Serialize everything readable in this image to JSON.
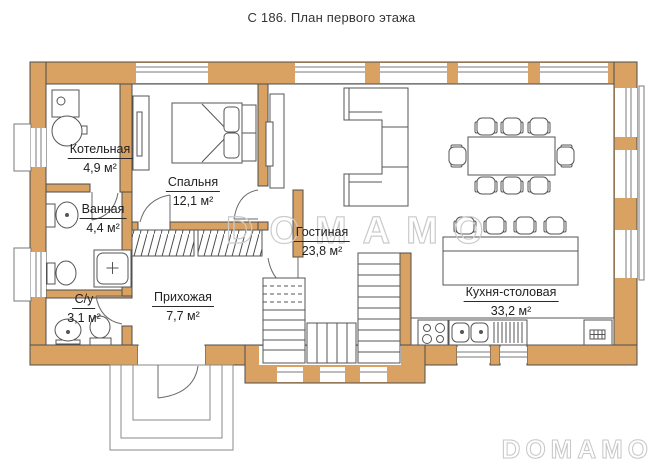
{
  "title": "С 186. План первого этажа",
  "watermark": {
    "center": "DOMAMO",
    "corner": "DOMAMO"
  },
  "colors": {
    "wall": "#d9a262",
    "outline": "#4d4d4d",
    "furniture_line": "#555555",
    "watermark_outline": "#cbcbcb",
    "background": "#ffffff"
  },
  "rooms": [
    {
      "name": "Котельная",
      "area": "4,9 м²"
    },
    {
      "name": "Спальня",
      "area": "12,1 м²"
    },
    {
      "name": "Ванная",
      "area": "4,4 м²"
    },
    {
      "name": "С/у",
      "area": "3,1 м²"
    },
    {
      "name": "Прихожая",
      "area": "7,7 м²"
    },
    {
      "name": "Гостиная",
      "area": "23,8 м²"
    },
    {
      "name": "Кухня-столовая",
      "area": "33,2 м²"
    }
  ]
}
